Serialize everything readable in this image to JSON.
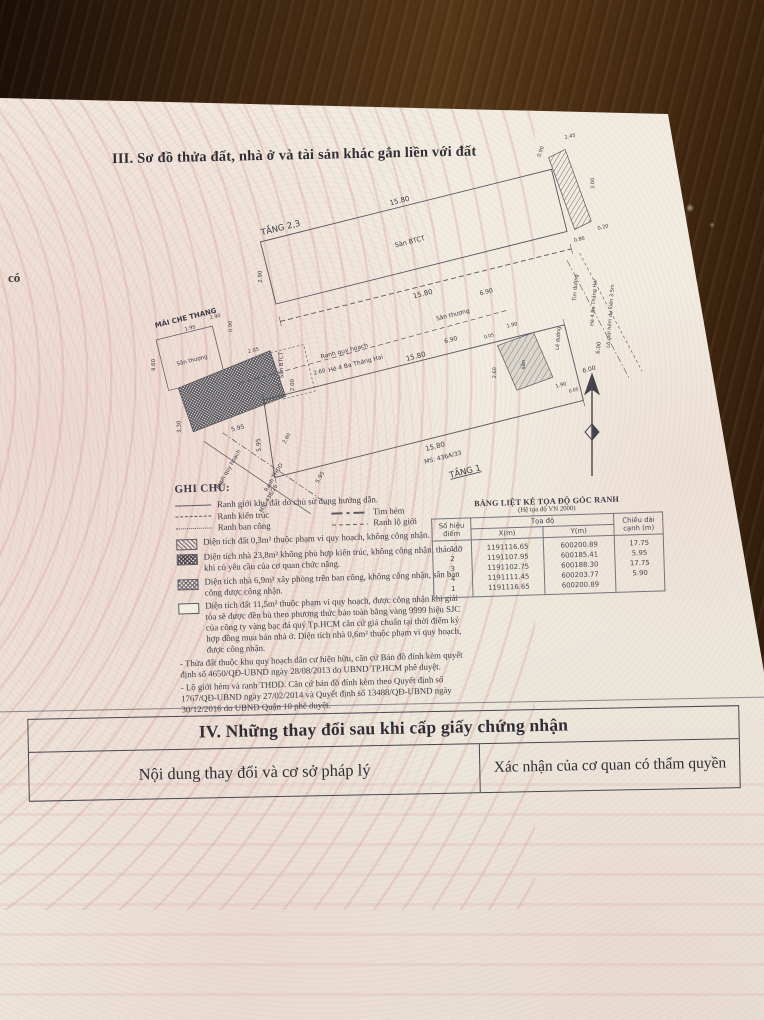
{
  "page": {
    "section3_title": "III. Sơ đồ thửa đất, nhà ở và tài sản khác gắn liền với đất",
    "left_margin_text": "có"
  },
  "diagram": {
    "labels": [
      {
        "t": "TẦNG 2,3",
        "x": 218,
        "y": 72,
        "s": 8.5
      },
      {
        "t": "15.80",
        "x": 340,
        "y": 74,
        "s": 7
      },
      {
        "t": "Sàn BTCT",
        "x": 340,
        "y": 116,
        "s": 6.5
      },
      {
        "t": "0.90",
        "x": 490,
        "y": 59,
        "s": 5,
        "r": -55
      },
      {
        "t": "2.45",
        "x": 521,
        "y": 52,
        "s": 5
      },
      {
        "t": "3.00",
        "x": 533,
        "y": 102,
        "s": 5,
        "r": -78
      },
      {
        "t": "0.20",
        "x": 531,
        "y": 148,
        "s": 5
      },
      {
        "t": "0.86",
        "x": 505,
        "y": 154,
        "s": 5
      },
      {
        "t": "2.90",
        "x": 188,
        "y": 112,
        "s": 5.5,
        "r": -78
      },
      {
        "t": "15.80",
        "x": 340,
        "y": 170,
        "s": 7
      },
      {
        "t": "6.90",
        "x": 402,
        "y": 183,
        "s": 6
      },
      {
        "t": "Sân thượng",
        "x": 364,
        "y": 197,
        "s": 6
      },
      {
        "t": "6.90",
        "x": 356,
        "y": 221,
        "s": 6
      },
      {
        "t": "MÁI CHE THANG",
        "x": 104,
        "y": 136,
        "s": 7,
        "b": 1
      },
      {
        "t": "1.95",
        "x": 106,
        "y": 146,
        "s": 5
      },
      {
        "t": "2.90",
        "x": 133,
        "y": 141,
        "s": 5
      },
      {
        "t": "0.90",
        "x": 147,
        "y": 153,
        "s": 5,
        "r": -78
      },
      {
        "t": "4.60",
        "x": 63,
        "y": 172,
        "s": 5.5,
        "r": -78
      },
      {
        "t": "Sân thượng",
        "x": 100,
        "y": 178,
        "s": 5.5
      },
      {
        "t": "Sàn BTCT",
        "x": 187,
        "y": 203,
        "s": 5.5,
        "r": -78
      },
      {
        "t": "2.05",
        "x": 162,
        "y": 183,
        "s": 5
      },
      {
        "t": "5.95",
        "x": 128,
        "y": 255,
        "s": 6
      },
      {
        "t": "3.30",
        "x": 73,
        "y": 238,
        "s": 5.5,
        "r": -78
      },
      {
        "t": "2.00",
        "x": 193,
        "y": 225,
        "s": 5.5,
        "r": -78
      },
      {
        "t": "2.60",
        "x": 221,
        "y": 220,
        "s": 5.5
      },
      {
        "t": "Ranh quy hoạch",
        "x": 110,
        "y": 292,
        "s": 5.5,
        "r": -46
      },
      {
        "t": "Ranh THDD",
        "x": 152,
        "y": 311,
        "s": 5.5,
        "r": -46
      },
      {
        "t": "MS: 436/26",
        "x": 142,
        "y": 330,
        "s": 5.5,
        "r": -46
      },
      {
        "t": "5.95",
        "x": 197,
        "y": 322,
        "s": 5.5,
        "r": -46
      },
      {
        "t": "2.60",
        "x": 174,
        "y": 276,
        "s": 5,
        "r": -46
      },
      {
        "t": "Ranh quy hoạch",
        "x": 250,
        "y": 206,
        "s": 6
      },
      {
        "t": "Hẻ 4 Ba Tháng Hai",
        "x": 258,
        "y": 221,
        "s": 6
      },
      {
        "t": "15.80",
        "x": 318,
        "y": 229,
        "s": 7
      },
      {
        "t": "5.95",
        "x": 146,
        "y": 275,
        "s": 6,
        "r": -80
      },
      {
        "t": "sân",
        "x": 422,
        "y": 261,
        "s": 5.5,
        "r": -75
      },
      {
        "t": "0.05",
        "x": 394,
        "y": 226,
        "s": 4.5
      },
      {
        "t": "1.90",
        "x": 419,
        "y": 221,
        "s": 5
      },
      {
        "t": "2.60",
        "x": 392,
        "y": 262,
        "s": 5,
        "r": -75
      },
      {
        "t": "1.90",
        "x": 452,
        "y": 291,
        "s": 5
      },
      {
        "t": "0.05",
        "x": 463,
        "y": 299,
        "s": 4.5
      },
      {
        "t": "6.00",
        "x": 483,
        "y": 283,
        "s": 6
      },
      {
        "t": "6.00",
        "x": 499,
        "y": 263,
        "s": 5.5,
        "r": -70
      },
      {
        "t": "Lề đường",
        "x": 462,
        "y": 244,
        "s": 5,
        "r": -72
      },
      {
        "t": "Tim đường",
        "x": 491,
        "y": 199,
        "s": 5,
        "r": -72
      },
      {
        "t": "Hẻ 4 Ba Tháng Hai",
        "x": 505,
        "y": 218,
        "s": 5,
        "r": -72
      },
      {
        "t": "Lộ giới hẻm dự kiến 3.5m",
        "x": 518,
        "y": 235,
        "s": 5,
        "r": -72
      },
      {
        "t": "15.80",
        "x": 315,
        "y": 321,
        "s": 7
      },
      {
        "t": "MS: 436A/33",
        "x": 320,
        "y": 333,
        "s": 6
      },
      {
        "t": "TẦNG 1",
        "x": 338,
        "y": 353,
        "s": 8.5,
        "u": 1
      }
    ]
  },
  "legend": {
    "title": "GHI CHÚ:",
    "lines": [
      {
        "label": "Ranh giới khu đất do chủ sử dụng hướng dẫn."
      },
      {
        "label": "Ranh kiến trúc"
      },
      {
        "label": "Tim hẻm"
      },
      {
        "label": "Ranh ban công"
      },
      {
        "label": "Ranh lộ giới"
      }
    ],
    "items": [
      {
        "text": "Diện tích đất 0,3m² thuộc phạm vi quy hoạch, không công nhận."
      },
      {
        "text": "Diện tích nhà 23,8m² không phù hợp kiến trúc, không công nhận, tháo dỡ khi có yêu cầu của cơ quan chức năng."
      },
      {
        "text": "Diện tích nhà 6,9m² xây phòng trên ban công, không công nhận, sân ban công được công nhận."
      },
      {
        "text": "Diện tích đất 11,5m² thuộc phạm vi quy hoạch, được công nhận khi giải tỏa sẽ được đền bù theo phương thức bảo toàn bằng vàng 9999 hiệu SJC của công ty vàng bạc đá quý Tp.HCM căn cứ giá chuẩn tại thời điểm ký hợp đồng mua bán nhà ở. Diện tích nhà 0,6m² thuộc phạm vi quy hoạch, được công nhận."
      }
    ],
    "notes": [
      "- Thửa đất thuộc khu quy hoạch dân cư hiện hữu, căn cứ Bản đồ đính kèm quyết định số 4650/QĐ-UBND ngày 28/08/2013 do UBND TP.HCM phê duyệt.",
      "- Lộ giới hẻm và ranh THDD. Căn cứ bản đồ đính kèm theo Quyết định số 1767/QĐ-UBND ngày 27/02/2014 và Quyết định số 13488/QĐ-UBND ngày 30/12/2016 do UBND Quận 10 phê duyệt."
    ]
  },
  "coord_table": {
    "title": "BẢNG LIỆT KÊ TỌA ĐỘ GÓC RANH",
    "subtitle": "(Hệ tọa độ VN 2000)",
    "col_point": "Số hiệu điểm",
    "col_coords": "Tọa độ",
    "col_x": "X(m)",
    "col_y": "Y(m)",
    "col_len": "Chiều dài cạnh (m)",
    "rows": [
      [
        "1",
        "1191116.65",
        "600200.89",
        "17.75"
      ],
      [
        "2",
        "1191107.95",
        "600185.41",
        "5.95"
      ],
      [
        "3",
        "1191102.75",
        "600188.30",
        "17.75"
      ],
      [
        "4",
        "1191111.45",
        "600203.77",
        "5.90"
      ],
      [
        "1",
        "1191116.65",
        "600200.89",
        ""
      ]
    ]
  },
  "section4": {
    "title": "IV. Những thay đổi sau khi cấp giấy chứng nhận",
    "col_left": "Nội dung thay đổi và cơ sở pháp lý",
    "col_right": "Xác nhận của cơ quan có thẩm quyền"
  }
}
